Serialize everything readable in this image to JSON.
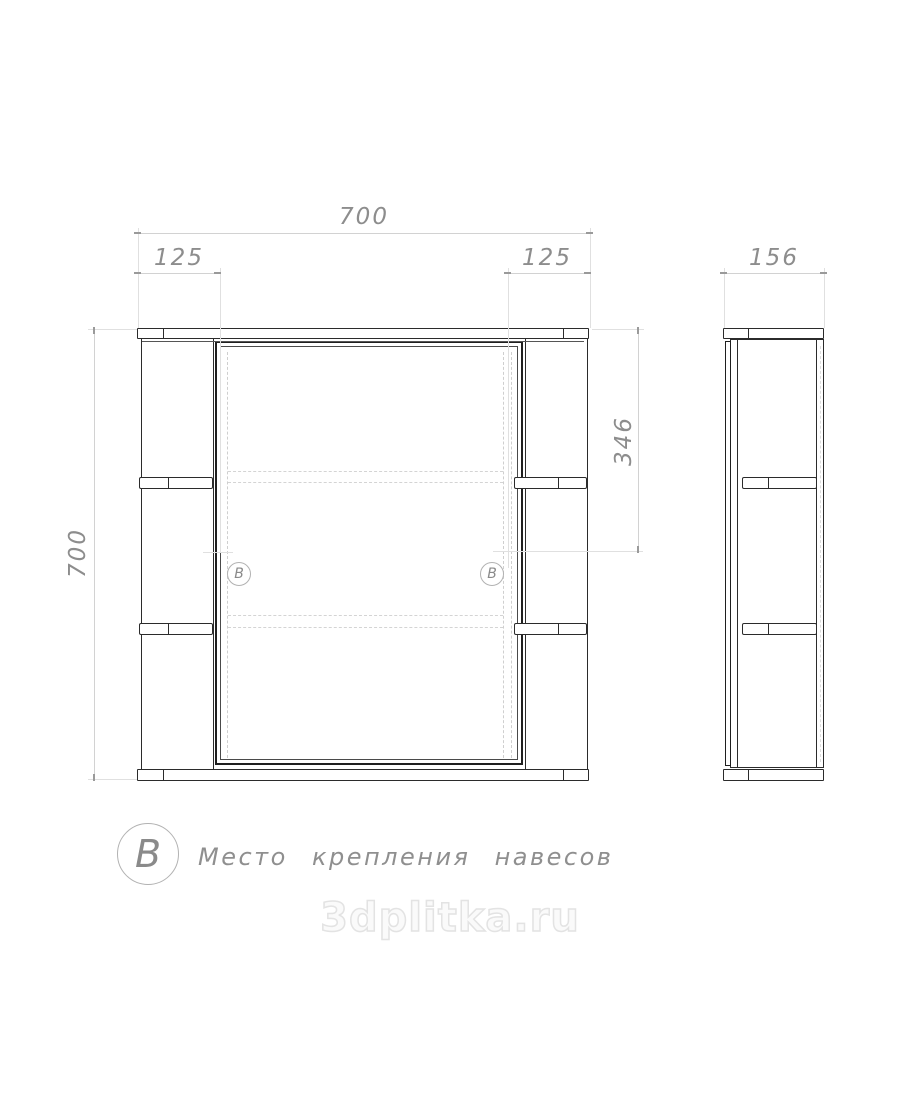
{
  "dimensions": {
    "front_width": "700",
    "front_height": "700",
    "shelf_offset_left": "125",
    "shelf_offset_right": "125",
    "mount_height": "346",
    "depth": "156"
  },
  "markers": {
    "left": "B",
    "right": "B"
  },
  "legend": {
    "symbol": "B",
    "label": "Место крепления навесов"
  },
  "watermark": {
    "text": "3dplitka.ru"
  },
  "colors": {
    "drawing_line": "#2b2b2b",
    "dimension_text": "#8d8d8d",
    "dimension_line": "#d2d2d2",
    "watermark_outline": "#e3e3e3"
  }
}
